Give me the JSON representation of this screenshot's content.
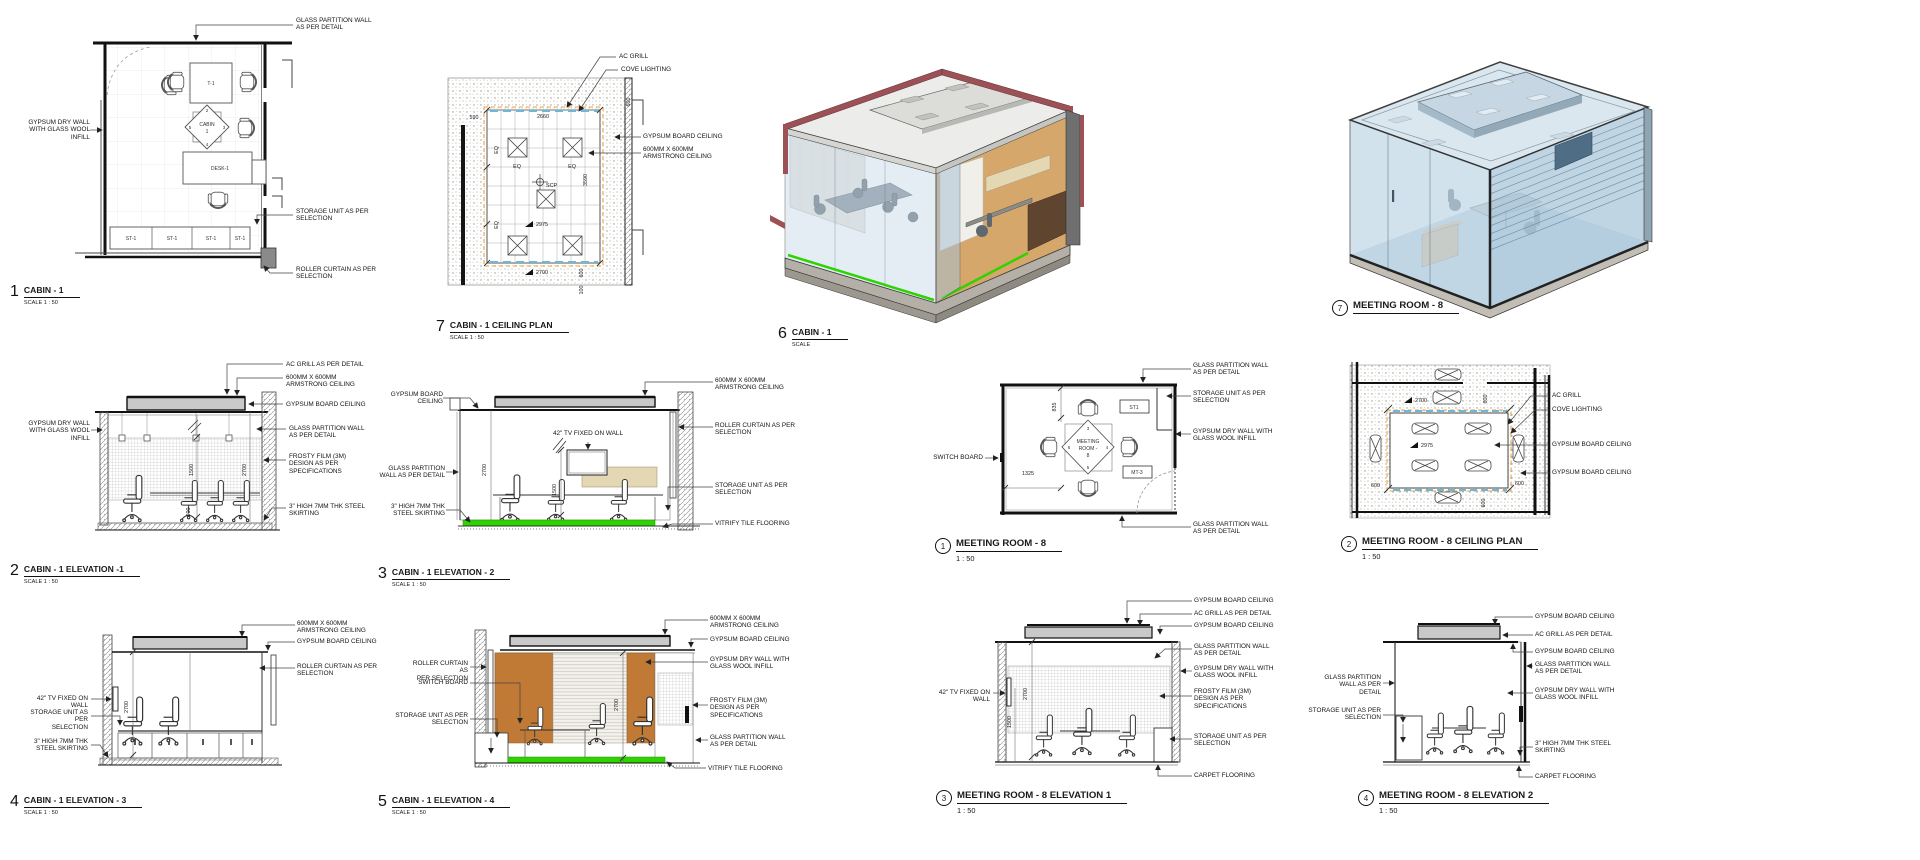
{
  "sheet": {
    "background": "#ffffff"
  },
  "colors": {
    "floor_green": "#2ed300",
    "wall_tan": "#d6a76b",
    "panel_orange": "#c07a35",
    "beam_maroon": "#9c5156",
    "glass_blue": "#c4d9e8",
    "panel_cream": "#e4d7b4",
    "ceiling_gray": "#c9c9c9",
    "cove_blue": "#6db8d8",
    "dash_orange": "#e8a33d",
    "credenza_brown": "#5f4430"
  },
  "drawings": {
    "cabin_plan": {
      "num": "1",
      "title": "CABIN - 1",
      "scale": "SCALE  1 : 50",
      "table": "T-1",
      "desk": "DESK-1",
      "st": "ST-1",
      "marker_name": "CABIN",
      "marker_no": "1",
      "m_top": "2",
      "m_right": "3",
      "m_bottom": "4",
      "m_left": "5",
      "ann_glass": "GLASS PARTITION WALL\nAS PER DETAIL",
      "ann_drywall": "GYPSUM DRY WALL\nWITH GLASS WOOL\nINFILL",
      "ann_storage": "STORAGE UNIT AS PER\nSELECTION",
      "ann_roller": "ROLLER CURTAIN AS PER\nSELECTION"
    },
    "cabin_ceiling": {
      "num": "7",
      "title": "CABIN - 1 CEILING PLAN",
      "scale": "SCALE  1 : 50",
      "ann_ac": "AC GRILL",
      "ann_cove": "COVE LIGHTING",
      "ann_gypsum": "GYPSUM BOARD CEILING",
      "ann_armstrong": "600MM X 600MM\nARMSTRONG CEILING",
      "dims": {
        "d590": "590",
        "d2660": "2660",
        "d600": "600",
        "eq": "EQ",
        "d3590": "3590",
        "d2975": "2975",
        "d2700": "2700",
        "d100": "100",
        "scp": "SCP"
      }
    },
    "cabin_3d": {
      "num": "6",
      "title": "CABIN - 1",
      "scale": "SCALE"
    },
    "meeting_3d": {
      "num": "7",
      "title": "MEETING ROOM - 8"
    },
    "cabin_elev1": {
      "num": "2",
      "title": "CABIN - 1 ELEVATION -1",
      "scale": "SCALE  1 : 50",
      "ann_ac": "AC GRILL AS PER DETAIL",
      "ann_armstrong": "600MM X 600MM\nARMSTRONG CEILING",
      "ann_gypsum": "GYPSUM BOARD CEILING",
      "ann_glass": "GLASS PARTITION WALL\nAS PER DETAIL",
      "ann_frosty": "FROSTY FILM (3M)\nDESIGN AS PER\nSPECIFICATIONS",
      "ann_skirting": "3\" HIGH 7MM THK STEEL\nSKIRTING",
      "ann_drywall": "GYPSUM DRY WALL\nWITH GLASS WOOL\nINFILL",
      "dims": {
        "d1500": "1500",
        "d2700": "2700",
        "d600": "600"
      }
    },
    "cabin_elev2": {
      "num": "3",
      "title": "CABIN - 1 ELEVATION - 2",
      "scale": "SCALE  1 : 50",
      "ann_gypsum": "GYPSUM BOARD\nCEILING",
      "ann_glass": "GLASS PARTITION\nWALL AS PER DETAIL",
      "ann_skirting": "3\" HIGH 7MM THK\nSTEEL SKIRTING",
      "ann_tv": "42\" TV FIXED ON WALL",
      "ann_armstrong": "600MM X 600MM\nARMSTRONG CEILING",
      "ann_roller": "ROLLER CURTAIN AS PER\nSELECTION",
      "ann_storage": "STORAGE UNIT AS PER\nSELECTION",
      "ann_vitrify": "VITRIFY TILE FLOORING",
      "dims": {
        "d2700": "2700",
        "d1500": "1500"
      }
    },
    "cabin_elev3": {
      "num": "4",
      "title": "CABIN - 1 ELEVATION - 3",
      "scale": "SCALE  1 : 50",
      "ann_tv": "42\" TV FIXED ON WALL",
      "ann_storage": "STORAGE UNIT AS PER\nSELECTION",
      "ann_skirting": "3\" HIGH 7MM THK\nSTEEL SKIRTING",
      "ann_armstrong": "600MM X 600MM\nARMSTRONG CEILING",
      "ann_gypsum": "GYPSUM BOARD CEILING",
      "ann_roller": "ROLLER CURTAIN AS PER\nSELECTION",
      "dims": {
        "d2700": "2700"
      }
    },
    "cabin_elev4": {
      "num": "5",
      "title": "CABIN - 1 ELEVATION - 4",
      "scale": "SCALE  1 : 50",
      "ann_roller": "ROLLER CURTAIN AS\nPER SELECTION",
      "ann_switch": "SWITCH BOARD",
      "ann_storage": "STORAGE UNIT AS PER\nSELECTION",
      "ann_armstrong": "600MM X 600MM\nARMSTRONG CEILING",
      "ann_gypsum": "GYPSUM BOARD CEILING",
      "ann_drywall": "GYPSUM DRY WALL WITH\nGLASS WOOL INFILL",
      "ann_frosty": "FROSTY FILM (3M)\nDESIGN AS PER\nSPECIFICATIONS",
      "ann_glass": "GLASS PARTITION WALL\nAS PER DETAIL",
      "ann_vitrify": "VITRIFY TILE FLOORING",
      "dims": {
        "d2700": "2700"
      }
    },
    "meeting_plan": {
      "num": "1",
      "title": "MEETING ROOM - 8",
      "scale": "1 : 50",
      "ann_switch": "SWITCH BOARD",
      "ann_glass_top": "GLASS PARTITION WALL\nAS PER DETAIL",
      "ann_storage": "STORAGE UNIT AS PER\nSELECTION",
      "ann_drywall": "GYPSUM DRY WALL WITH\nGLASS WOOL INFILL",
      "ann_glass_bottom": "GLASS PARTITION WALL\nAS PER DETAIL",
      "st1": "ST1",
      "mt3": "MT-3",
      "marker_l1": "MEETING",
      "marker_l2": "ROOM -",
      "marker_l3": "8",
      "m_top": "3",
      "m_right": "4",
      "m_bottom": "5",
      "m_left": "6",
      "dims": {
        "d835": "835",
        "d1325": "1325"
      }
    },
    "meeting_ceiling": {
      "num": "2",
      "title": "MEETING ROOM - 8 CEILING PLAN",
      "scale": "1 : 50",
      "ann_ac": "AC GRILL",
      "ann_cove": "COVE LIGHTING",
      "ann_gypsum1": "GYPSUM BOARD CEILING",
      "ann_gypsum2": "GYPSUM BOARD CEILING",
      "dims": {
        "d2700": "2700",
        "d600": "600",
        "d2975": "2975"
      }
    },
    "meeting_elev1": {
      "num": "3",
      "title": "MEETING ROOM - 8 ELEVATION 1",
      "scale": "1 : 50",
      "ann_tv": "42\" TV FIXED ON WALL",
      "ann_gypsum1": "GYPSUM BOARD CEILING",
      "ann_ac": "AC GRILL AS PER DETAIL",
      "ann_gypsum2": "GYPSUM BOARD CEILING",
      "ann_glass": "GLASS PARTITION WALL\nAS PER DETAIL",
      "ann_drywall": "GYPSUM DRY WALL WITH\nGLASS WOOL INFILL",
      "ann_frosty": "FROSTY FILM (3M)\nDESIGN AS PER\nSPECIFICATIONS",
      "ann_storage": "STORAGE UNIT AS PER\nSELECTION",
      "ann_carpet": "CARPET FLOORING",
      "dims": {
        "d2700": "2700",
        "d1500": "1500"
      }
    },
    "meeting_elev2": {
      "num": "4",
      "title": "MEETING ROOM - 8 ELEVATION 2",
      "scale": "1 : 50",
      "ann_glass_left": "GLASS PARTITION\nWALL AS PER DETAIL",
      "ann_storage": "STORAGE UNIT AS PER\nSELECTION",
      "ann_gypsum1": "GYPSUM BOARD CEILING",
      "ann_ac": "AC GRILL AS PER DETAIL",
      "ann_gypsum2": "GYPSUM BOARD CEILING",
      "ann_glass": "GLASS PARTITION WALL\nAS PER DETAIL",
      "ann_drywall": "GYPSUM DRY WALL WITH\nGLASS WOOL INFILL",
      "ann_skirting": "3\" HIGH 7MM THK STEEL\nSKIRTING",
      "ann_carpet": "CARPET FLOORING"
    }
  }
}
